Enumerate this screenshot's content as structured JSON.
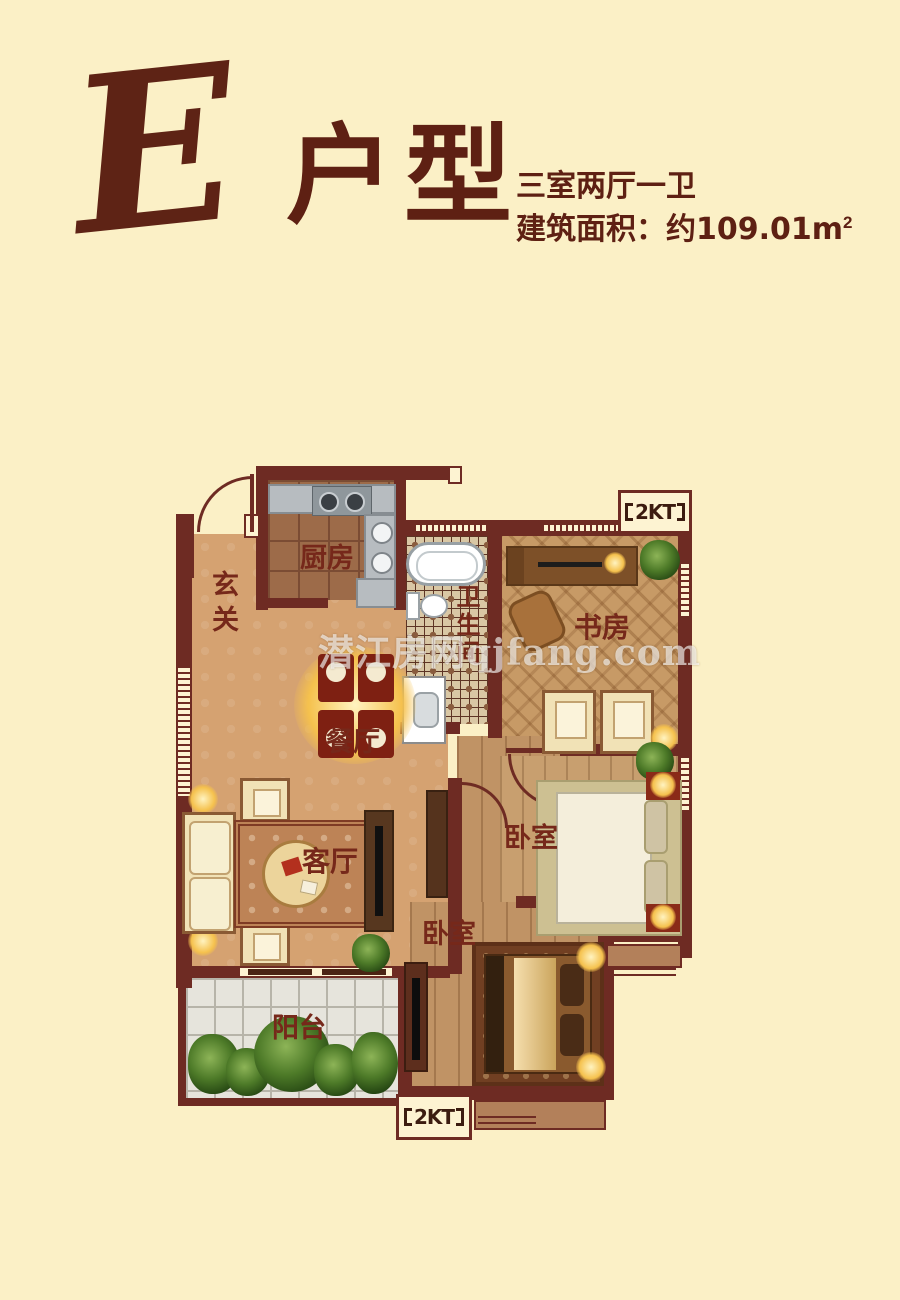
{
  "header": {
    "letter": "E",
    "title": "户型",
    "layout_spec": "三室两厅一卫",
    "area_prefix": "建筑面积：约",
    "area_value": "109.01",
    "area_unit": "m",
    "area_exponent": "2"
  },
  "watermark": "潜江房网qjfang.com",
  "rooms": {
    "entry": "玄关",
    "kitchen": "厨房",
    "bathroom": "卫生间",
    "study": "书房",
    "dining": "餐厅",
    "living": "客厅",
    "bedroom_right": "卧室",
    "bedroom_bottom": "卧室",
    "balcony": "阳台"
  },
  "markers": {
    "ac_top": "2KT",
    "ac_bottom": "2KT"
  },
  "colors": {
    "background": "#fbf0c6",
    "accent_text": "#5e2013",
    "wall": "#6e2b23",
    "main_floor": "#d5a271",
    "kitchen_floor": "#9d6b49",
    "balcony_tile": "#e6e4dc",
    "lamp_glow": "#f5c14d",
    "plant_green": "#4d7a28"
  }
}
